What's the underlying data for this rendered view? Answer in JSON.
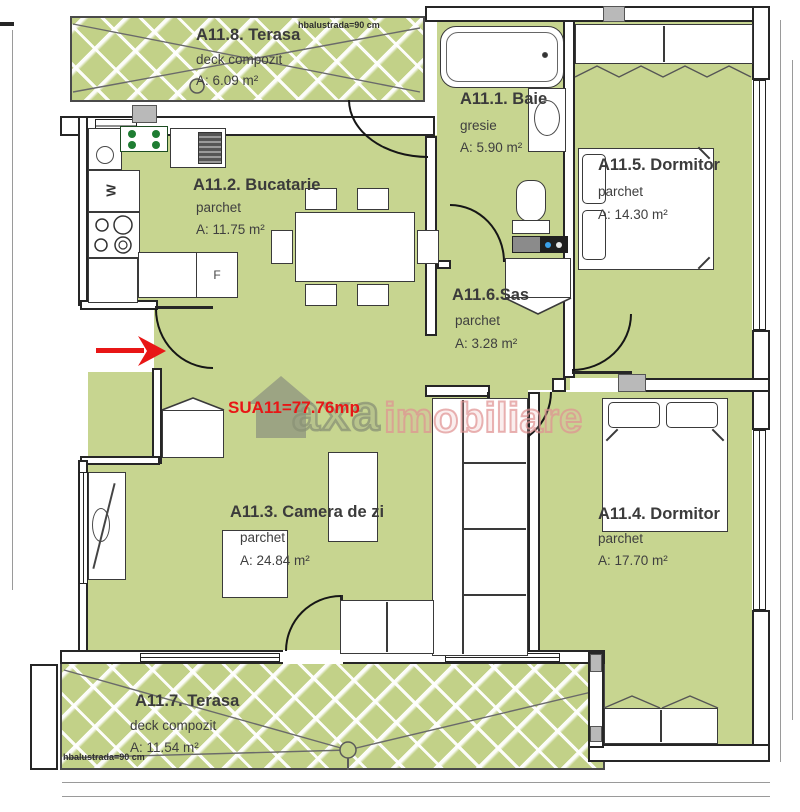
{
  "plan": {
    "total_area": "SUA11=77.76mp",
    "balustrade": "hbalustrada=90 cm",
    "watermark": {
      "axa": "axa",
      "imobiliare": "imobiliare"
    },
    "appliances": {
      "washer": "W",
      "fridge": "F"
    },
    "rooms": {
      "terasa8": {
        "name": "A11.8. Terasa",
        "finish": "deck compozit",
        "area": "A: 6.09 m²"
      },
      "baie": {
        "name": "A11.1. Baie",
        "finish": "gresie",
        "area": "A: 5.90 m²"
      },
      "bucatarie": {
        "name": "A11.2. Bucatarie",
        "finish": "parchet",
        "area": "A: 11.75 m²"
      },
      "dormitor5": {
        "name": "A11.5. Dormitor",
        "finish": "parchet",
        "area": "A: 14.30 m²"
      },
      "sas": {
        "name": "A11.6.Sas",
        "finish": "parchet",
        "area": "A: 3.28 m²"
      },
      "camera": {
        "name": "A11.3. Camera de zi",
        "finish": "parchet",
        "area": "A: 24.84 m²"
      },
      "dormitor4": {
        "name": "A11.4. Dormitor",
        "finish": "parchet",
        "area": "A: 17.70 m²"
      },
      "terasa7": {
        "name": "A11.7. Terasa",
        "finish": "deck compozit",
        "area": "A: 11.54 m²"
      }
    },
    "colors": {
      "floor_green": "#c7d590",
      "accent_red": "#e81616",
      "wall": "#262626"
    }
  }
}
